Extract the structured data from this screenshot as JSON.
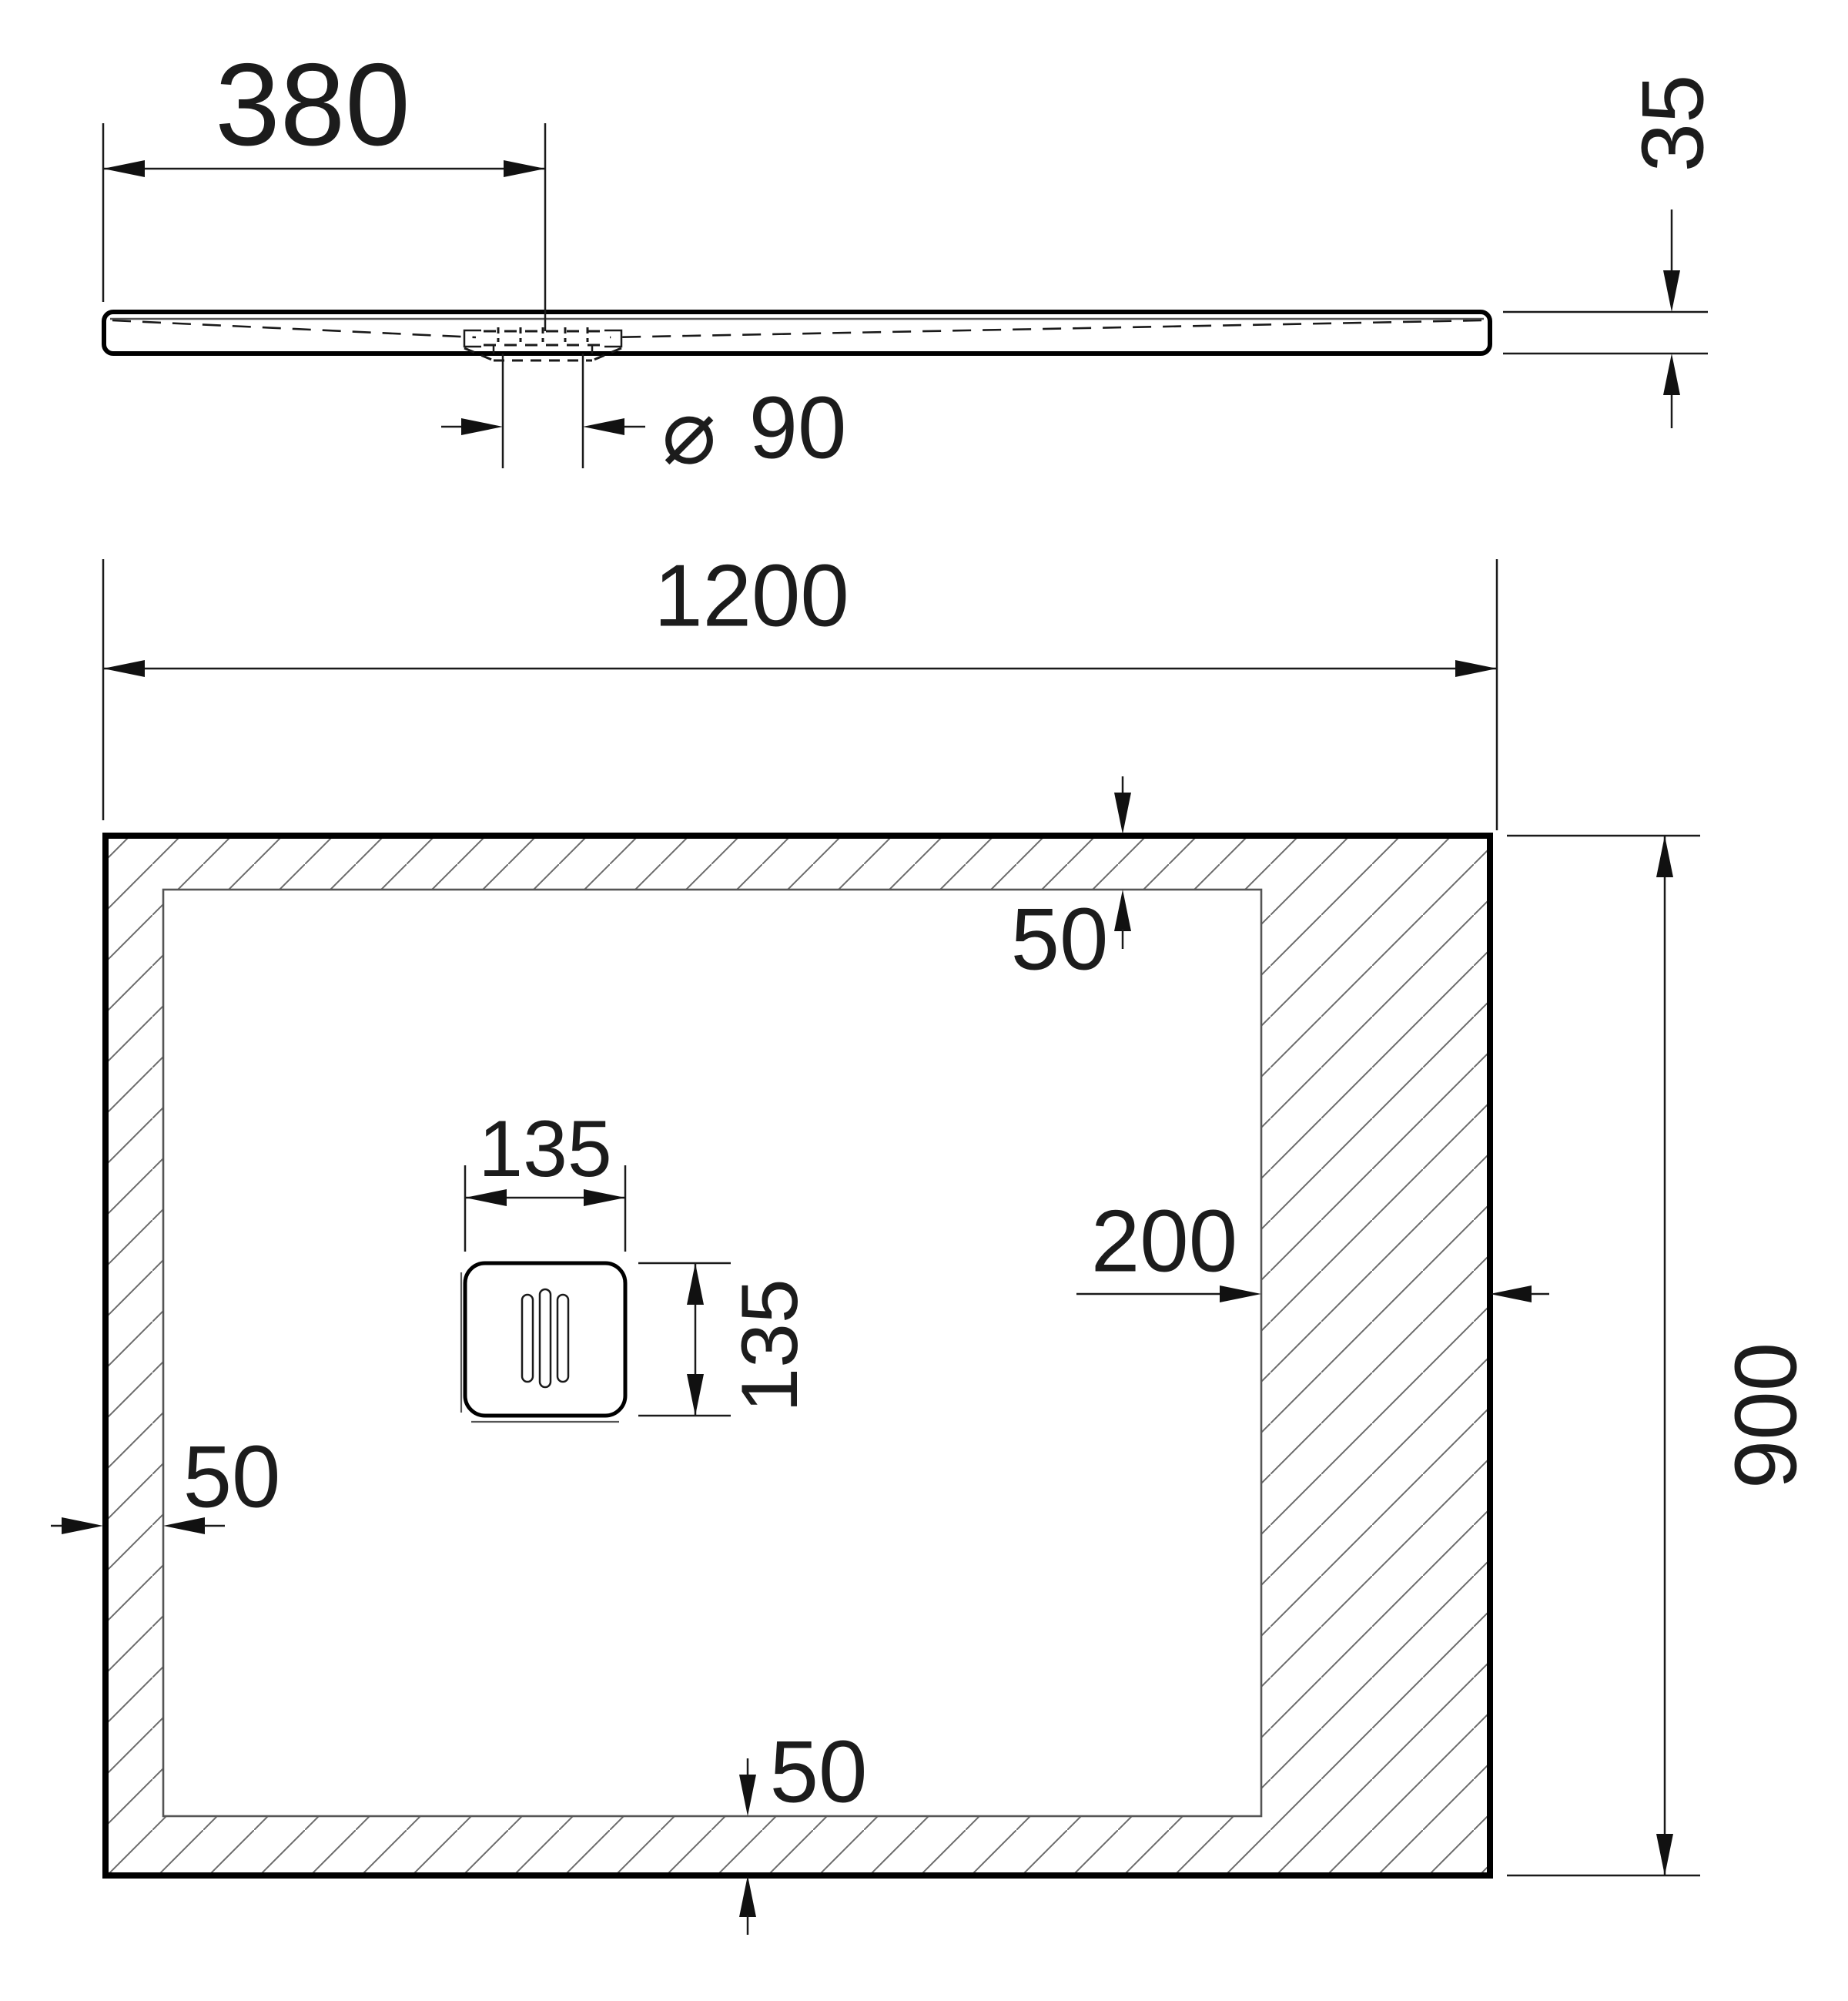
{
  "drawing": {
    "section_view": {
      "dim_drain_offset": "380",
      "dim_height": "35",
      "diameter_symbol": "⌀",
      "dim_drain_diameter": "90"
    },
    "plan_view": {
      "dim_width": "1200",
      "dim_height": "900",
      "dim_margin_top": "50",
      "dim_margin_left": "50",
      "dim_margin_bottom": "50",
      "dim_margin_right": "200",
      "dim_drain_width": "135",
      "dim_drain_height": "135"
    }
  }
}
